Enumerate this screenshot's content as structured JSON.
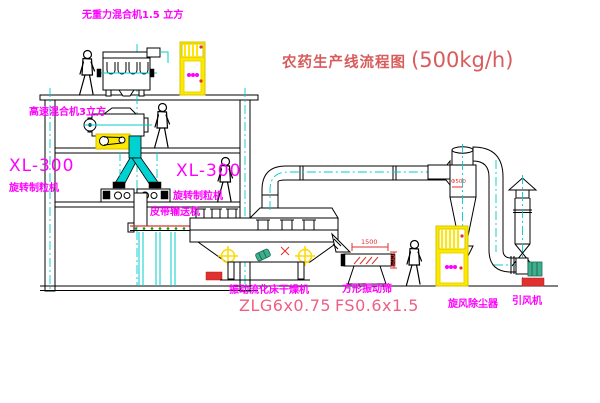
{
  "title": {
    "text": "农药生产线流程图",
    "capacity": "(500kg/h)"
  },
  "labels": {
    "gravity_mixer": "无重力混合机1.5 立方",
    "high_speed_mixer": "高速混合机3立方",
    "granulator_left_model": "XL-300",
    "granulator_left_name": "旋转制粒机",
    "granulator_right_model": "XL-300",
    "granulator_right_name": "旋转制粒机",
    "belt_conveyor": "皮带输送机",
    "dryer_name": "振动流化床干燥机",
    "dryer_model": "ZLG6x0.75",
    "sieve_name": "方形振动筛",
    "sieve_model": "FS0.6x1.5",
    "cyclone_name": "旋风除尘器",
    "fan_name": "引风机"
  },
  "dimensions": {
    "sieve_length": "1500",
    "sieve_height": "600",
    "cyclone_note": "Φ500"
  },
  "colors": {
    "label_magenta": "#ff00ff",
    "title_red": "#d85c5c",
    "model_pink": "#ee5f85",
    "line_black": "#000000",
    "centerline_cyan": "#00cccc",
    "chute_cyan": "#00d2d2",
    "cabinet_yellow": "#ffe800",
    "accent_red": "#e03030",
    "dot_green": "#00a000"
  }
}
